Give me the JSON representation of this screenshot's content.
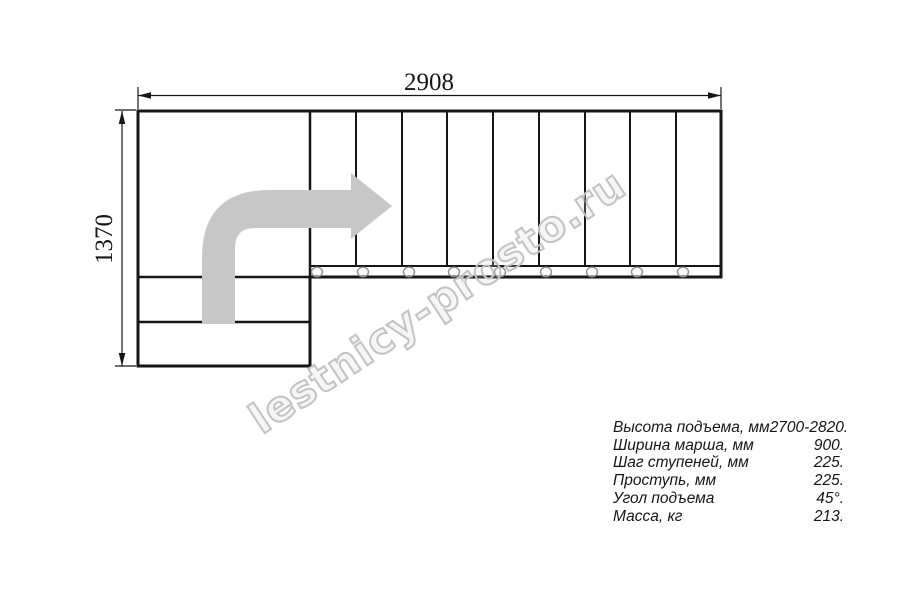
{
  "drawing": {
    "title": "staircase-plan",
    "top_dimension_mm": "2908",
    "left_dimension_mm": "1370",
    "tread_count_top_flight": 9,
    "lower_steps_count": 2
  },
  "specs": [
    {
      "label": "Высота подъема, мм",
      "value": "2700-2820."
    },
    {
      "label": "Ширина марша, мм",
      "value": "900."
    },
    {
      "label": "Шаг ступеней, мм",
      "value": "225."
    },
    {
      "label": "Проступь, мм",
      "value": "225."
    },
    {
      "label": "Угол подъема",
      "value": "45°."
    },
    {
      "label": "Масса, кг",
      "value": "213."
    }
  ],
  "watermark": "lestnicy-prosto.ru",
  "colors": {
    "line": "#161616",
    "direction_arrow": "#c7c7c7",
    "watermark_outline": "#c3c3c3",
    "fastener_circle": "#8f8f8f",
    "background": "#ffffff"
  }
}
